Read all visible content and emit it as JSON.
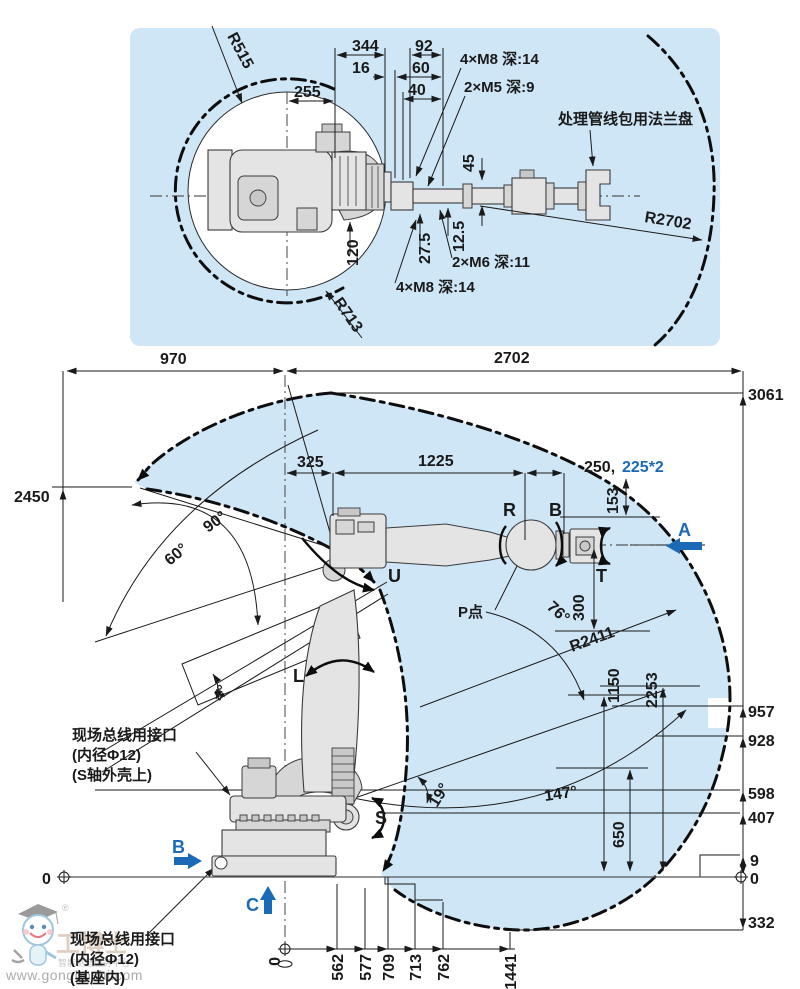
{
  "colors": {
    "accent_blue": "#1a6ab8",
    "panel_blue": "#cfe6f6",
    "line_black": "#1a1a1a"
  },
  "top_view": {
    "r515": "R515",
    "dim_344": "344",
    "dim_92": "92",
    "dim_16": "16",
    "dim_60": "60",
    "dim_40": "40",
    "dim_255": "255",
    "bolt_top": "4×M8 深:14",
    "bolt_m5": "2×M5 深:9",
    "flange_note": "处理管线包用法兰盘",
    "r2702": "R2702",
    "dim_45": "45",
    "dim_12_5": "12.5",
    "dim_27_5": "27.5",
    "dim_120": "120",
    "bolt_m6": "2×M6 深:11",
    "bolt_bottom": "4×M8 深:14",
    "r713": "R713"
  },
  "side_view": {
    "dim_970": "970",
    "dim_2702": "2702",
    "dim_3061": "3061",
    "dim_2450": "2450",
    "dim_325": "325",
    "dim_1225": "1225",
    "dim_250": "250,",
    "dim_225": "225*2",
    "dim_153": "153",
    "angle_90": "90°",
    "angle_60": "60°",
    "angle_76": "76°",
    "angle_4": "4°",
    "angle_147": "147°",
    "angle_19": "19°",
    "axis_r": "R",
    "axis_b": "B",
    "axis_t": "T",
    "axis_u": "U",
    "axis_l": "L",
    "axis_s": "S",
    "view_a": "A",
    "view_b": "B",
    "view_c": "C",
    "p_point": "P点",
    "r2411": "R2411",
    "dim_1150": "1150",
    "dim_2253": "2253",
    "dim_300": "300",
    "dim_957": "957",
    "dim_928": "928",
    "dim_598": "598",
    "dim_407": "407",
    "dim_650": "650",
    "dim_9": "9",
    "dim_332": "332",
    "zero_left": "0",
    "zero_right": "0",
    "zero_bottom": "0",
    "bottom_dims": [
      "562",
      "577",
      "709",
      "713",
      "762",
      "1441"
    ],
    "fieldbus_s": {
      "l1": "现场总线用接口",
      "l2": "(内径Φ12)",
      "l3": "(S轴外壳上)"
    },
    "fieldbus_base": {
      "l1": "现场总线用接口",
      "l2": "(内径Φ12)",
      "l3": "(基座内)"
    }
  },
  "watermark": {
    "site": "www.gongboshi.com",
    "brand": "工博士",
    "slogan": "智能制造服务平台",
    "reg": "®"
  }
}
